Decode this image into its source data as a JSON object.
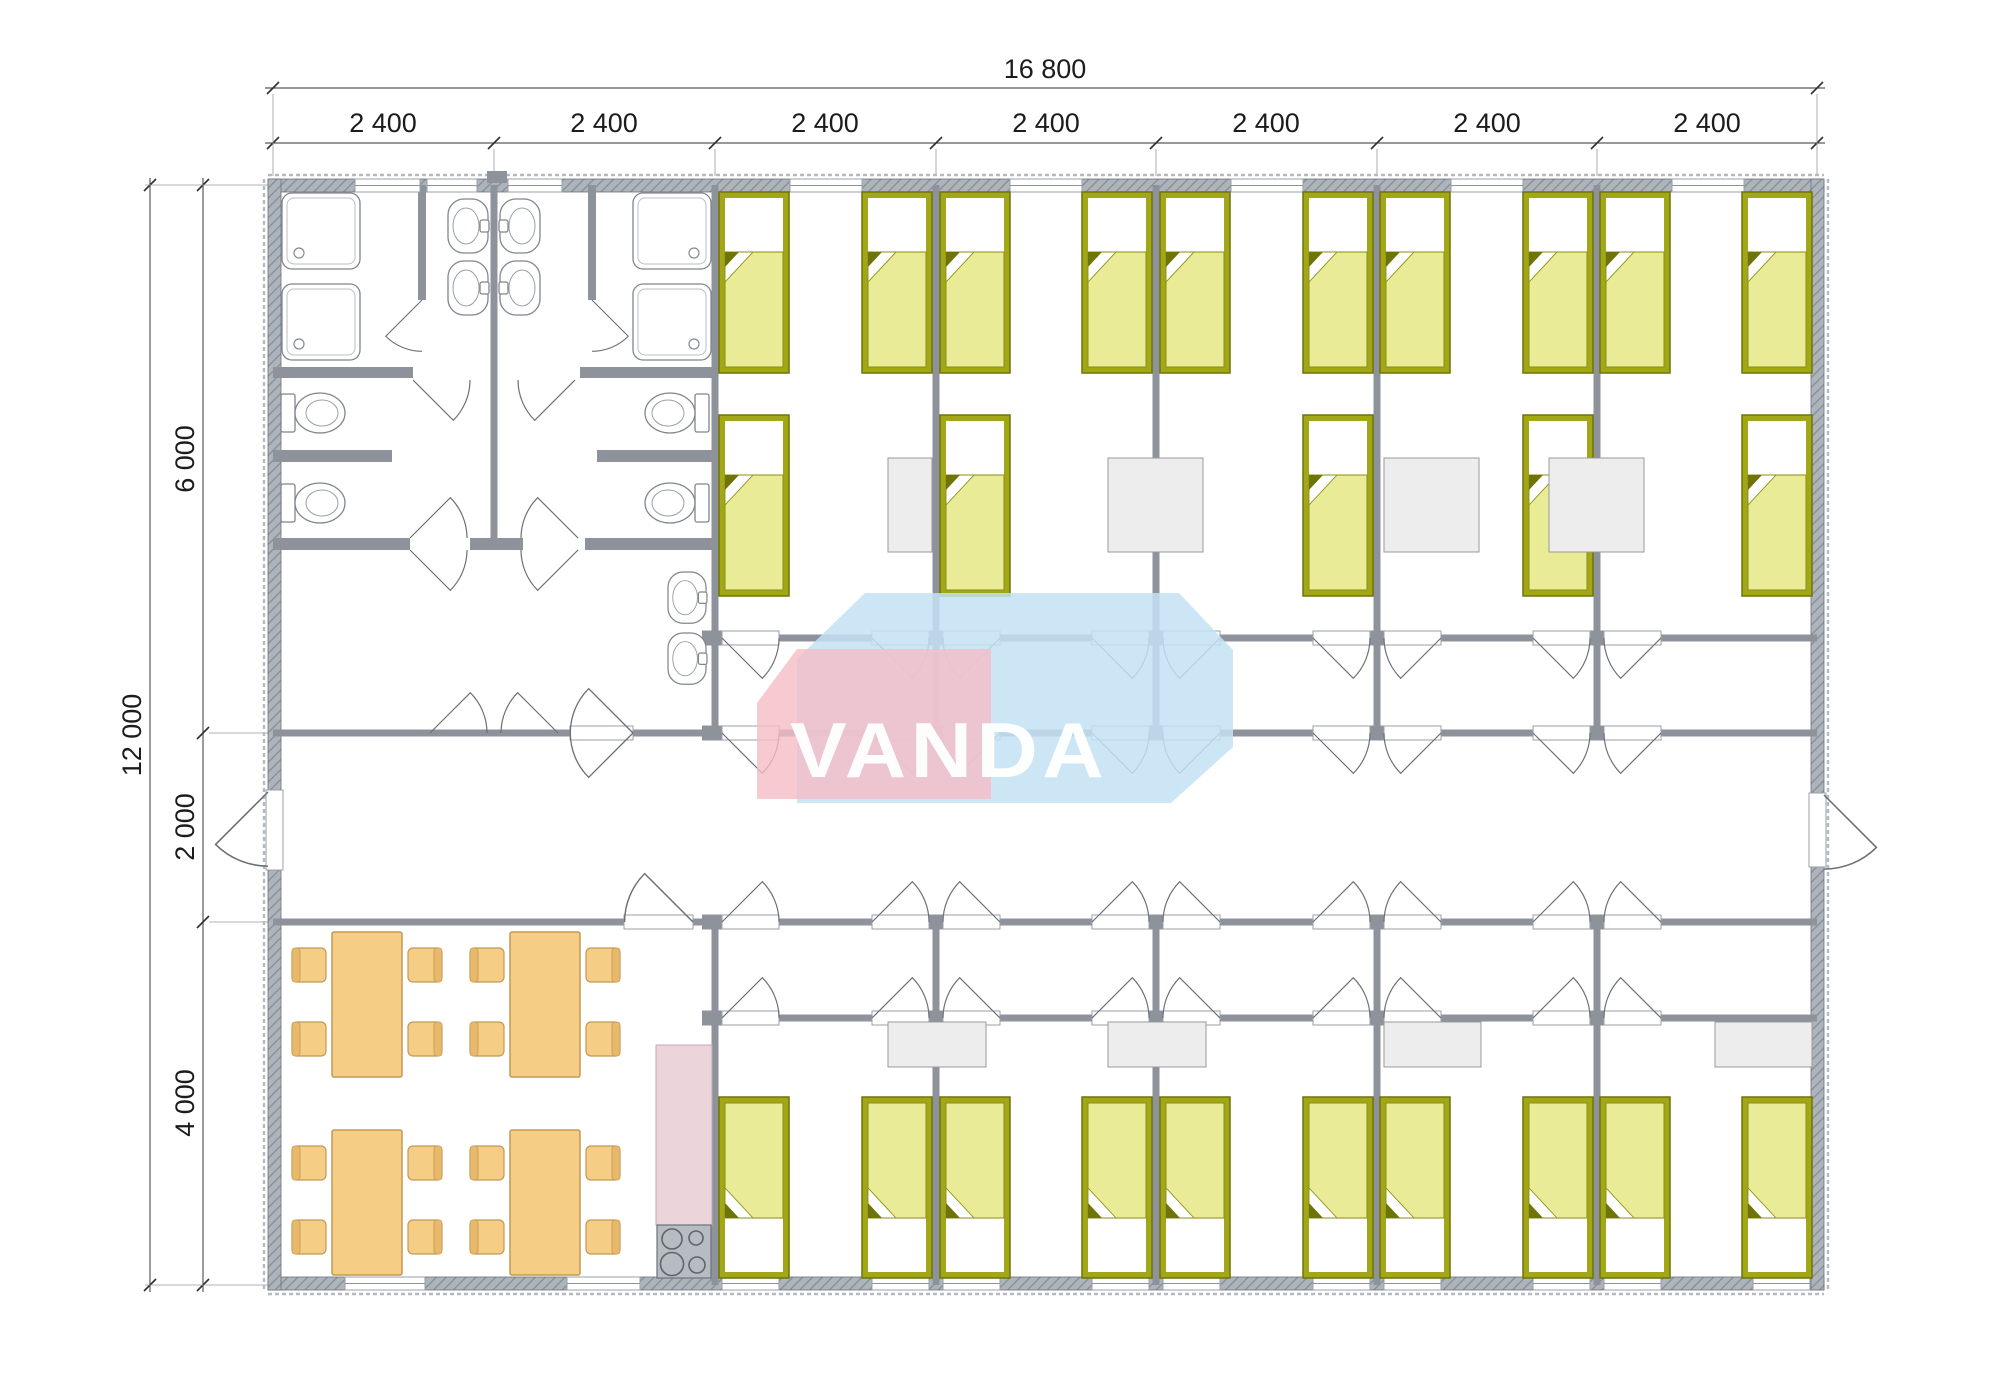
{
  "brand": {
    "logo_text": "VANDA",
    "logo_pink": "#f5bdc7",
    "logo_blue": "#c4e2f4",
    "logo_text_color": "#ffffff"
  },
  "dimensions": {
    "top_total": "16 800",
    "top_segments": [
      "2 400",
      "2 400",
      "2 400",
      "2 400",
      "2 400",
      "2 400",
      "2 400"
    ],
    "side_total": "12 000",
    "side_segments": [
      "6 000",
      "2 000",
      "4 000"
    ]
  },
  "palette": {
    "wall_gray": "#8e939b",
    "exterior_wall_gray": "#99a0a9",
    "bed_frame_olive": "#a2a718",
    "bed_blanket_yellow": "#e9eb96",
    "bedside_table_gray": "#ededee",
    "dining_furniture_orange": "#f6cd85",
    "kitchen_counter_pink": "#ebd4da",
    "stove_gray": "#b7bcc2",
    "dimension_text": "#1c1c1c"
  },
  "inventory": {
    "single_beds": 25,
    "bedside_tables": 8,
    "dining_tables": 4,
    "chairs": 16,
    "shower_trays": 4,
    "toilets": 4,
    "washbasins": 6,
    "stoves": 1
  }
}
